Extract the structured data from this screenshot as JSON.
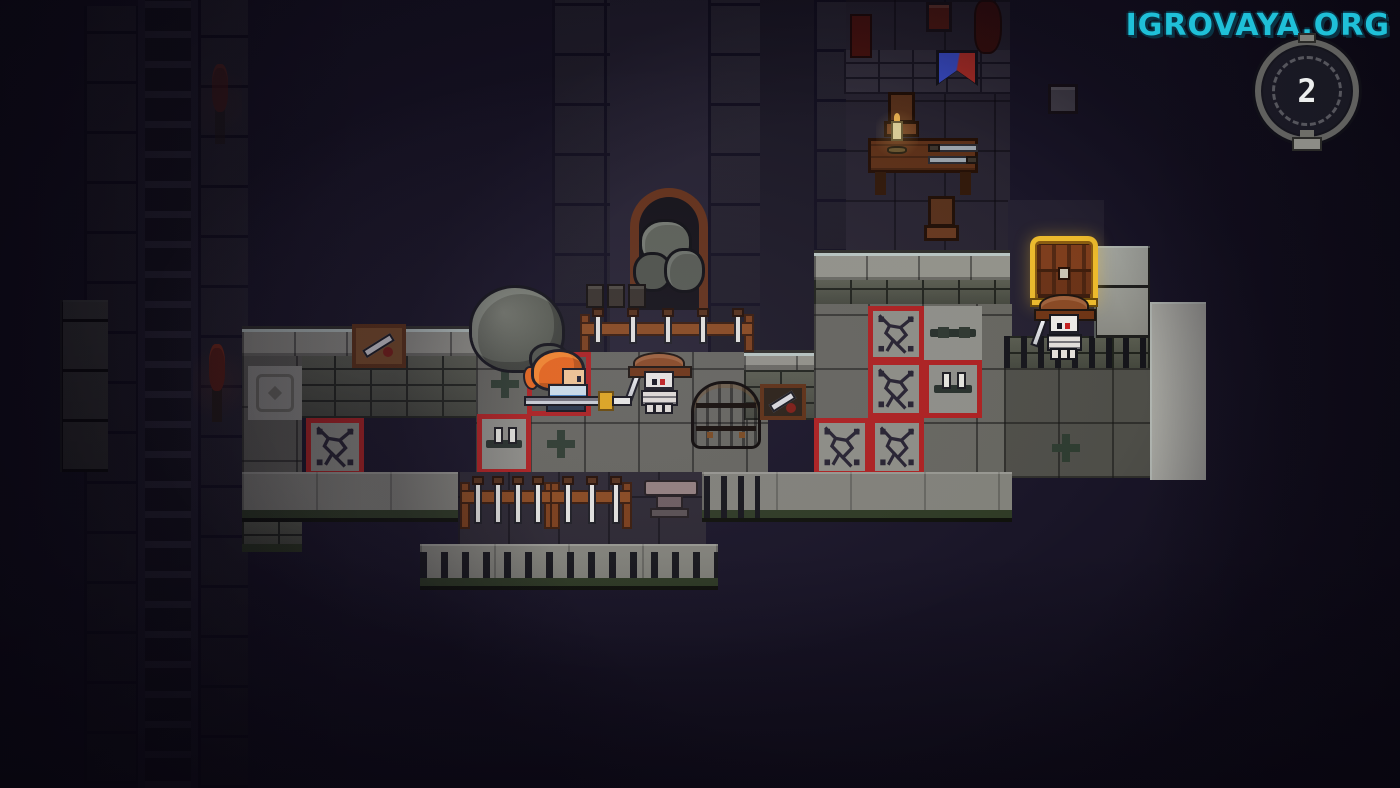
{
  "watermark": {
    "text": "IGROVAYA.ORG",
    "color": "#1fc0d8"
  },
  "hud": {
    "timer_value": "2"
  },
  "palette": {
    "background": "#191527",
    "floor_grey": "#66665f",
    "wall_light": "#a8a8a2",
    "trap_border_red": "#ae2020",
    "pressure_plate_green": "#2e3c30",
    "chest_gold": "#ecba2c",
    "player_hair_orange": "#e8661c",
    "player_shirt_blue": "#4e86c2",
    "skeleton_bone": "#e4e0da",
    "skeleton_helmet_brown": "#8a4a24",
    "watermark_cyan": "#1fc0d8"
  },
  "scene": {
    "sprites": [
      {
        "name": "left-wall-column-a",
        "type": "walldark",
        "x": 84,
        "y": 6,
        "w": 54,
        "h": 778,
        "p": {
          "blocks": true
        }
      },
      {
        "name": "left-ladder",
        "type": "ladder",
        "x": 138,
        "y": 0,
        "w": 60,
        "h": 788
      },
      {
        "name": "left-wall-column-b",
        "type": "walldark",
        "x": 198,
        "y": 0,
        "w": 50,
        "h": 788,
        "p": {
          "blocks": true
        }
      },
      {
        "name": "left-wall-lit",
        "type": "wallblocks",
        "x": 60,
        "y": 300,
        "w": 48,
        "h": 172,
        "p": {
          "dim": true
        }
      },
      {
        "name": "left-torch-top",
        "type": "torch",
        "x": 210,
        "y": 64,
        "w": 20,
        "h": 80,
        "p": {
          "dim": true
        }
      },
      {
        "name": "left-torch",
        "type": "torch",
        "x": 205,
        "y": 344,
        "w": 24,
        "h": 78
      },
      {
        "name": "corridor-wall-left",
        "type": "walldark",
        "x": 552,
        "y": 0,
        "w": 58,
        "h": 356,
        "p": {
          "blocks": true
        }
      },
      {
        "name": "corridor-floor",
        "type": "walldark",
        "x": 610,
        "y": 0,
        "w": 100,
        "h": 356,
        "p": {
          "shade": "#262232"
        }
      },
      {
        "name": "corridor-wall-right",
        "type": "walldark",
        "x": 708,
        "y": 0,
        "w": 54,
        "h": 356,
        "p": {
          "blocks": true
        }
      },
      {
        "name": "divider-wall",
        "type": "walldark",
        "x": 760,
        "y": 0,
        "w": 56,
        "h": 352,
        "p": {
          "shade": "#1c1926"
        }
      },
      {
        "name": "room-floor",
        "type": "roomfloor",
        "x": 844,
        "y": 0,
        "w": 166,
        "h": 252
      },
      {
        "name": "room-wall-left",
        "type": "walldark",
        "x": 814,
        "y": 0,
        "w": 32,
        "h": 252,
        "p": {
          "blocks": true
        }
      },
      {
        "name": "room-wall-top",
        "type": "bricksdark",
        "x": 844,
        "y": 50,
        "w": 166,
        "h": 44
      },
      {
        "name": "chest-alcove-wall",
        "type": "walldark",
        "x": 1008,
        "y": 200,
        "w": 96,
        "h": 172,
        "p": {
          "shade": "#242030"
        }
      },
      {
        "name": "ledge-a-cap",
        "type": "cap",
        "x": 242,
        "y": 326,
        "w": 248,
        "h": 32
      },
      {
        "name": "ledge-a-bricks",
        "type": "bricks",
        "x": 298,
        "y": 356,
        "w": 190,
        "h": 62
      },
      {
        "name": "left-floor-strip",
        "type": "floor",
        "x": 242,
        "y": 356,
        "w": 60,
        "h": 160,
        "p": {
          "shade": "#5c5c55"
        }
      },
      {
        "name": "hatch-tile",
        "type": "hatch",
        "x": 248,
        "y": 366,
        "w": 54,
        "h": 54
      },
      {
        "name": "left-strip-ledge",
        "type": "bricks",
        "x": 242,
        "y": 514,
        "w": 60,
        "h": 38,
        "p": {
          "moss": true
        }
      },
      {
        "name": "center-floor",
        "type": "floor",
        "x": 476,
        "y": 352,
        "w": 292,
        "h": 126
      },
      {
        "name": "pressure-plate-1",
        "type": "plate",
        "x": 478,
        "y": 356,
        "w": 54,
        "h": 56
      },
      {
        "name": "player-trap-tile",
        "type": "trap",
        "x": 527,
        "y": 352,
        "w": 64,
        "h": 64,
        "p": {
          "dark": true
        }
      },
      {
        "name": "spike-trap-tile-1",
        "type": "spikebar",
        "x": 477,
        "y": 414,
        "w": 54,
        "h": 60,
        "p": {
          "red": true
        }
      },
      {
        "name": "pressure-plate-2",
        "type": "plate",
        "x": 532,
        "y": 414,
        "w": 58,
        "h": 60
      },
      {
        "name": "trap-tile-isolated",
        "type": "trap",
        "x": 306,
        "y": 418,
        "w": 58,
        "h": 58
      },
      {
        "name": "ledge-b-cap",
        "type": "cap",
        "x": 744,
        "y": 350,
        "w": 126,
        "h": 20
      },
      {
        "name": "ledge-b-bricks",
        "type": "bricks",
        "x": 744,
        "y": 370,
        "w": 126,
        "h": 50
      },
      {
        "name": "upper-ledge-cap",
        "type": "cap",
        "x": 814,
        "y": 250,
        "w": 196,
        "h": 32
      },
      {
        "name": "upper-ledge-bricks",
        "type": "bricks",
        "x": 814,
        "y": 280,
        "w": 196,
        "h": 26
      },
      {
        "name": "right-floor",
        "type": "floor",
        "x": 814,
        "y": 304,
        "w": 198,
        "h": 174
      },
      {
        "name": "trap-tile-1",
        "type": "trap",
        "x": 868,
        "y": 306,
        "w": 56,
        "h": 56
      },
      {
        "name": "spike-trap-tile-2",
        "type": "spikebar",
        "x": 924,
        "y": 306,
        "w": 58,
        "h": 54
      },
      {
        "name": "trap-tile-2",
        "type": "trap",
        "x": 868,
        "y": 360,
        "w": 56,
        "h": 58
      },
      {
        "name": "spike-trap-tile-3",
        "type": "spikebar",
        "x": 924,
        "y": 360,
        "w": 58,
        "h": 58,
        "p": {
          "red": true
        }
      },
      {
        "name": "trap-tile-3",
        "type": "trap",
        "x": 814,
        "y": 418,
        "w": 56,
        "h": 58
      },
      {
        "name": "trap-tile-4",
        "type": "trap",
        "x": 870,
        "y": 418,
        "w": 54,
        "h": 58
      },
      {
        "name": "chest-ledge-fence",
        "type": "bricks",
        "x": 1004,
        "y": 336,
        "w": 150,
        "h": 34,
        "p": {
          "fence": true
        }
      },
      {
        "name": "right-lower-floor",
        "type": "floor",
        "x": 1004,
        "y": 368,
        "w": 200,
        "h": 110,
        "p": {
          "shade": "#4e4e48"
        }
      },
      {
        "name": "pressure-plate-3",
        "type": "plate",
        "x": 1038,
        "y": 420,
        "w": 56,
        "h": 56
      },
      {
        "name": "right-wall-blocks-a",
        "type": "wallblocks",
        "x": 1094,
        "y": 246,
        "w": 56,
        "h": 92
      },
      {
        "name": "right-wall-blocks-b",
        "type": "wallblocks",
        "x": 1150,
        "y": 302,
        "w": 56,
        "h": 178,
        "p": {
          "light": true
        }
      },
      {
        "name": "lower-wall-left",
        "type": "wallface",
        "x": 242,
        "y": 472,
        "w": 222,
        "h": 50
      },
      {
        "name": "lower-room-floor",
        "type": "roomfloor",
        "x": 458,
        "y": 472,
        "w": 248,
        "h": 76,
        "p": {
          "shade": "#2c2832"
        }
      },
      {
        "name": "lower-wall-right",
        "type": "wallface",
        "x": 702,
        "y": 472,
        "w": 310,
        "h": 50
      },
      {
        "name": "lower-fence",
        "type": "fence",
        "x": 704,
        "y": 476,
        "w": 56,
        "h": 42
      },
      {
        "name": "lower-room-wall",
        "type": "wallface",
        "x": 420,
        "y": 544,
        "w": 298,
        "h": 46,
        "p": {
          "posts": true
        }
      },
      {
        "name": "wall-shield-a",
        "type": "shieldmount",
        "x": 352,
        "y": 324,
        "w": 54,
        "h": 44,
        "p": {
          "tan": true
        }
      },
      {
        "name": "boulder",
        "type": "boulder",
        "x": 472,
        "y": 288,
        "w": 90,
        "h": 82
      },
      {
        "name": "rubble-arch",
        "type": "arch",
        "x": 630,
        "y": 188,
        "w": 78,
        "h": 122
      },
      {
        "name": "small-crates",
        "type": "crates",
        "x": 586,
        "y": 284,
        "w": 62,
        "h": 24
      },
      {
        "name": "weapon-rack-top",
        "type": "rack",
        "x": 582,
        "y": 310,
        "w": 170,
        "h": 50,
        "p": {
          "blades": 5
        }
      },
      {
        "name": "weapon-rack-low-1",
        "type": "rack",
        "x": 462,
        "y": 478,
        "w": 90,
        "h": 62,
        "p": {
          "blades": 4
        }
      },
      {
        "name": "weapon-rack-low-2",
        "type": "rack",
        "x": 552,
        "y": 478,
        "w": 78,
        "h": 62,
        "p": {
          "blades": 3
        }
      },
      {
        "name": "anvil",
        "type": "anvil",
        "x": 644,
        "y": 476,
        "w": 54,
        "h": 48
      },
      {
        "name": "barrel",
        "type": "barrel",
        "x": 694,
        "y": 384,
        "w": 64,
        "h": 62
      },
      {
        "name": "wall-shield-b",
        "type": "shieldmount",
        "x": 760,
        "y": 384,
        "w": 46,
        "h": 36
      },
      {
        "name": "banner-pennant",
        "type": "pennant",
        "x": 936,
        "y": 50,
        "w": 42,
        "h": 36
      },
      {
        "name": "wall-banner-red",
        "type": "redbanner",
        "x": 850,
        "y": 14,
        "w": 22,
        "h": 44
      },
      {
        "name": "wall-plant",
        "type": "redbanner",
        "x": 974,
        "y": 0,
        "w": 28,
        "h": 54,
        "p": {
          "blob": true
        }
      },
      {
        "name": "chair-top",
        "type": "chair",
        "x": 884,
        "y": 92,
        "w": 38,
        "h": 52
      },
      {
        "name": "table",
        "type": "table",
        "x": 868,
        "y": 138,
        "w": 110,
        "h": 58
      },
      {
        "name": "candle",
        "type": "candle",
        "x": 886,
        "y": 112,
        "w": 22,
        "h": 44
      },
      {
        "name": "table-knives",
        "type": "tableknives",
        "x": 928,
        "y": 142,
        "w": 50,
        "h": 26
      },
      {
        "name": "chair-bottom",
        "type": "chair",
        "x": 924,
        "y": 196,
        "w": 38,
        "h": 52
      },
      {
        "name": "grey-box",
        "type": "box",
        "x": 1048,
        "y": 84,
        "w": 30,
        "h": 30,
        "p": {
          "shade": "#4a4650"
        }
      },
      {
        "name": "red-box",
        "type": "box",
        "x": 926,
        "y": 2,
        "w": 26,
        "h": 30,
        "p": {
          "shade": "#541a12"
        }
      },
      {
        "name": "treasure-chest",
        "type": "chest",
        "x": 1030,
        "y": 236,
        "w": 68,
        "h": 70
      },
      {
        "name": "skeleton-enemy-2",
        "type": "skeleton",
        "x": 1036,
        "y": 294,
        "w": 58,
        "h": 66
      },
      {
        "name": "skeleton-enemy-1",
        "type": "skeleton",
        "x": 630,
        "y": 352,
        "w": 60,
        "h": 62
      },
      {
        "name": "player",
        "type": "player",
        "x": 524,
        "y": 350,
        "w": 112,
        "h": 66
      }
    ]
  }
}
